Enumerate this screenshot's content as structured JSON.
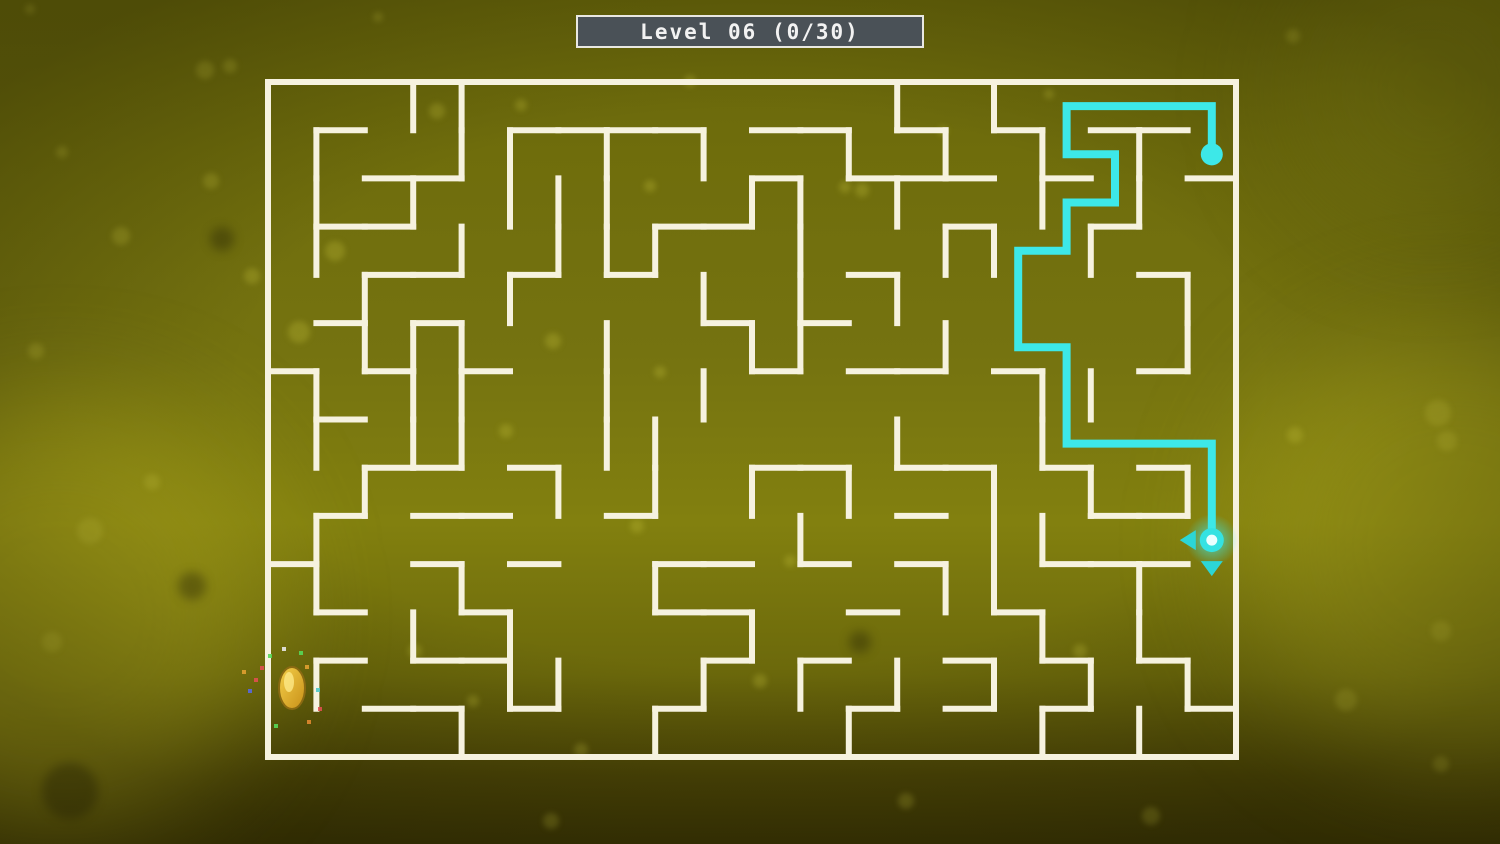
{
  "title_bar": {
    "text": "Level 06 (0/30)",
    "level": "06",
    "coins_collected": "0",
    "coins_total": "30",
    "bg_color": "#4a5157",
    "border_color": "#e9e8e2",
    "text_color": "#f2f2f2"
  },
  "background": {
    "gradient_stops": [
      [
        "#67650a",
        0
      ],
      [
        "#6f6d0c",
        18
      ],
      [
        "#757310",
        42
      ],
      [
        "#82800f",
        62
      ],
      [
        "#6b680b",
        80
      ],
      [
        "#4a4406",
        92
      ],
      [
        "#3a3504",
        100
      ]
    ],
    "bright_blobs": [
      {
        "x": 60,
        "y": 615,
        "r": 210,
        "color": "rgba(185,180,30,0.50)"
      },
      {
        "x": 1455,
        "y": 545,
        "r": 215,
        "color": "rgba(178,173,28,0.45)"
      },
      {
        "x": 1430,
        "y": 90,
        "r": 140,
        "color": "rgba(150,148,22,0.30)"
      }
    ],
    "bokeh_light": [
      [
        205,
        70,
        9
      ],
      [
        230,
        66,
        7
      ],
      [
        378,
        17,
        5
      ],
      [
        690,
        81,
        6
      ],
      [
        650,
        186,
        6
      ],
      [
        862,
        190,
        7
      ],
      [
        943,
        131,
        5
      ],
      [
        1049,
        94,
        5
      ],
      [
        1293,
        36,
        7
      ],
      [
        121,
        236,
        9
      ],
      [
        211,
        181,
        8
      ],
      [
        62,
        152,
        6
      ],
      [
        36,
        351,
        8
      ],
      [
        90,
        531,
        13
      ],
      [
        52,
        642,
        10
      ],
      [
        152,
        482,
        8
      ],
      [
        335,
        251,
        10
      ],
      [
        252,
        276,
        8
      ],
      [
        299,
        332,
        11
      ],
      [
        553,
        341,
        8
      ],
      [
        506,
        431,
        7
      ],
      [
        637,
        526,
        7
      ],
      [
        660,
        372,
        6
      ],
      [
        437,
        111,
        8
      ],
      [
        521,
        105,
        6
      ],
      [
        415,
        651,
        7
      ],
      [
        760,
        681,
        7
      ],
      [
        581,
        750,
        7
      ],
      [
        1438,
        413,
        13
      ],
      [
        1447,
        441,
        10
      ],
      [
        1295,
        435,
        8
      ],
      [
        1441,
        631,
        10
      ],
      [
        1346,
        700,
        11
      ],
      [
        1441,
        764,
        8
      ],
      [
        1151,
        816,
        9
      ],
      [
        906,
        801,
        8
      ],
      [
        551,
        821,
        8
      ],
      [
        473,
        701,
        6
      ],
      [
        790,
        561,
        6
      ],
      [
        1080,
        651,
        7
      ],
      [
        30,
        9,
        5
      ],
      [
        845,
        187,
        6
      ]
    ],
    "bokeh_light_color": "rgba(200,198,60,0.28)",
    "bokeh_dark": [
      [
        70,
        791,
        28
      ],
      [
        192,
        586,
        14
      ],
      [
        860,
        642,
        11
      ],
      [
        222,
        239,
        12
      ]
    ],
    "bokeh_dark_color": "rgba(28,25,2,0.35)"
  },
  "maze": {
    "origin_x": 268,
    "origin_y": 82,
    "cols": 20,
    "rows": 14,
    "cell_w": 48.4,
    "cell_h": 48.214,
    "wall_color": "#f6f2df",
    "wall_thickness": 6,
    "walls_h": [
      [
        1,
        1
      ],
      [
        1,
        5
      ],
      [
        1,
        6
      ],
      [
        1,
        7
      ],
      [
        1,
        8
      ],
      [
        1,
        10
      ],
      [
        1,
        11
      ],
      [
        1,
        13
      ],
      [
        1,
        15
      ],
      [
        1,
        17
      ],
      [
        1,
        18
      ],
      [
        2,
        2
      ],
      [
        2,
        3
      ],
      [
        2,
        10
      ],
      [
        2,
        12
      ],
      [
        2,
        13
      ],
      [
        2,
        14
      ],
      [
        2,
        16
      ],
      [
        2,
        19
      ],
      [
        3,
        1
      ],
      [
        3,
        2
      ],
      [
        3,
        8
      ],
      [
        3,
        9
      ],
      [
        3,
        14
      ],
      [
        3,
        17
      ],
      [
        4,
        2
      ],
      [
        4,
        3
      ],
      [
        4,
        5
      ],
      [
        4,
        7
      ],
      [
        4,
        12
      ],
      [
        4,
        18
      ],
      [
        5,
        1
      ],
      [
        5,
        3
      ],
      [
        5,
        9
      ],
      [
        5,
        11
      ],
      [
        6,
        0
      ],
      [
        6,
        2
      ],
      [
        6,
        4
      ],
      [
        6,
        10
      ],
      [
        6,
        12
      ],
      [
        6,
        13
      ],
      [
        6,
        15
      ],
      [
        6,
        18
      ],
      [
        7,
        1
      ],
      [
        8,
        2
      ],
      [
        8,
        3
      ],
      [
        8,
        5
      ],
      [
        8,
        10
      ],
      [
        8,
        11
      ],
      [
        8,
        13
      ],
      [
        8,
        14
      ],
      [
        8,
        16
      ],
      [
        8,
        18
      ],
      [
        9,
        1
      ],
      [
        9,
        3
      ],
      [
        9,
        4
      ],
      [
        9,
        7
      ],
      [
        9,
        13
      ],
      [
        9,
        17
      ],
      [
        9,
        18
      ],
      [
        10,
        0
      ],
      [
        10,
        3
      ],
      [
        10,
        5
      ],
      [
        10,
        8
      ],
      [
        10,
        9
      ],
      [
        10,
        11
      ],
      [
        10,
        13
      ],
      [
        10,
        16
      ],
      [
        10,
        17
      ],
      [
        10,
        18
      ],
      [
        11,
        1
      ],
      [
        11,
        4
      ],
      [
        11,
        8
      ],
      [
        11,
        9
      ],
      [
        11,
        12
      ],
      [
        11,
        15
      ],
      [
        12,
        1
      ],
      [
        12,
        3
      ],
      [
        12,
        4
      ],
      [
        12,
        9
      ],
      [
        12,
        11
      ],
      [
        12,
        14
      ],
      [
        12,
        16
      ],
      [
        12,
        18
      ],
      [
        13,
        2
      ],
      [
        13,
        3
      ],
      [
        13,
        5
      ],
      [
        13,
        8
      ],
      [
        13,
        12
      ],
      [
        13,
        14
      ],
      [
        13,
        16
      ],
      [
        13,
        19
      ]
    ],
    "walls_v": [
      [
        0,
        3
      ],
      [
        0,
        4
      ],
      [
        0,
        13
      ],
      [
        0,
        15
      ],
      [
        1,
        1
      ],
      [
        1,
        4
      ],
      [
        1,
        5
      ],
      [
        1,
        7
      ],
      [
        1,
        9
      ],
      [
        1,
        12
      ],
      [
        1,
        14
      ],
      [
        1,
        16
      ],
      [
        1,
        18
      ],
      [
        2,
        1
      ],
      [
        2,
        3
      ],
      [
        2,
        5
      ],
      [
        2,
        6
      ],
      [
        2,
        7
      ],
      [
        2,
        10
      ],
      [
        2,
        11
      ],
      [
        2,
        13
      ],
      [
        2,
        16
      ],
      [
        2,
        18
      ],
      [
        3,
        1
      ],
      [
        3,
        4
      ],
      [
        3,
        6
      ],
      [
        3,
        7
      ],
      [
        3,
        8
      ],
      [
        3,
        11
      ],
      [
        3,
        14
      ],
      [
        3,
        15
      ],
      [
        3,
        17
      ],
      [
        4,
        2
      ],
      [
        4,
        5
      ],
      [
        4,
        9
      ],
      [
        4,
        11
      ],
      [
        4,
        13
      ],
      [
        4,
        19
      ],
      [
        5,
        2
      ],
      [
        5,
        3
      ],
      [
        5,
        4
      ],
      [
        5,
        7
      ],
      [
        5,
        10
      ],
      [
        5,
        11
      ],
      [
        5,
        14
      ],
      [
        5,
        19
      ],
      [
        6,
        1
      ],
      [
        6,
        3
      ],
      [
        6,
        4
      ],
      [
        6,
        7
      ],
      [
        6,
        9
      ],
      [
        6,
        16
      ],
      [
        6,
        17
      ],
      [
        7,
        1
      ],
      [
        7,
        3
      ],
      [
        7,
        4
      ],
      [
        7,
        7
      ],
      [
        7,
        8
      ],
      [
        7,
        13
      ],
      [
        7,
        16
      ],
      [
        8,
        2
      ],
      [
        8,
        6
      ],
      [
        8,
        8
      ],
      [
        8,
        10
      ],
      [
        8,
        12
      ],
      [
        8,
        15
      ],
      [
        8,
        17
      ],
      [
        8,
        19
      ],
      [
        9,
        1
      ],
      [
        9,
        11
      ],
      [
        9,
        15
      ],
      [
        9,
        16
      ],
      [
        10,
        1
      ],
      [
        10,
        4
      ],
      [
        10,
        8
      ],
      [
        10,
        14
      ],
      [
        10,
        15
      ],
      [
        10,
        18
      ],
      [
        11,
        3
      ],
      [
        11,
        5
      ],
      [
        11,
        10
      ],
      [
        11,
        16
      ],
      [
        11,
        18
      ],
      [
        12,
        1
      ],
      [
        12,
        5
      ],
      [
        12,
        6
      ],
      [
        12,
        9
      ],
      [
        12,
        11
      ],
      [
        12,
        13
      ],
      [
        12,
        15
      ],
      [
        12,
        17
      ],
      [
        12,
        19
      ],
      [
        13,
        4
      ],
      [
        13,
        8
      ],
      [
        13,
        12
      ],
      [
        13,
        16
      ],
      [
        13,
        18
      ]
    ]
  },
  "solution_path": {
    "color": "#3de8e8",
    "width": 8,
    "cells": [
      [
        19,
        1
      ],
      [
        19,
        0
      ],
      [
        16,
        0
      ],
      [
        16,
        1
      ],
      [
        17,
        1
      ],
      [
        17,
        2
      ],
      [
        16,
        2
      ],
      [
        16,
        3
      ],
      [
        15,
        3
      ],
      [
        15,
        5
      ],
      [
        16,
        5
      ],
      [
        16,
        7
      ],
      [
        19,
        7
      ],
      [
        19,
        9
      ]
    ],
    "start_dot_cell": [
      19,
      1
    ],
    "start_dot_radius": 11
  },
  "player": {
    "cell": [
      19,
      9
    ],
    "x": 1211.8,
    "y": 540.1,
    "glow_color": "#3de8e8",
    "body_color": "#35e2e2",
    "core_color": "#eaffff",
    "available_moves": [
      "left",
      "down"
    ],
    "arrow_color": "#2cd6d6"
  },
  "goal_coin": {
    "x": 292,
    "y": 688,
    "rx": 13,
    "ry": 21,
    "fill_top": "#f4cf4a",
    "fill_bottom": "#c89018",
    "stroke": "#8a6a12",
    "sparkles": [
      [
        270,
        656,
        "#58d858"
      ],
      [
        284,
        649,
        "#e8e8e8"
      ],
      [
        301,
        653,
        "#58d858"
      ],
      [
        262,
        668,
        "#e05050"
      ],
      [
        256,
        680,
        "#e05050"
      ],
      [
        250,
        691,
        "#5868e0"
      ],
      [
        307,
        667,
        "#e0a030"
      ],
      [
        320,
        709,
        "#e05050"
      ],
      [
        309,
        722,
        "#e08830"
      ],
      [
        276,
        726,
        "#58d858"
      ],
      [
        318,
        690,
        "#50c8c8"
      ],
      [
        244,
        672,
        "#e0a030"
      ]
    ]
  }
}
